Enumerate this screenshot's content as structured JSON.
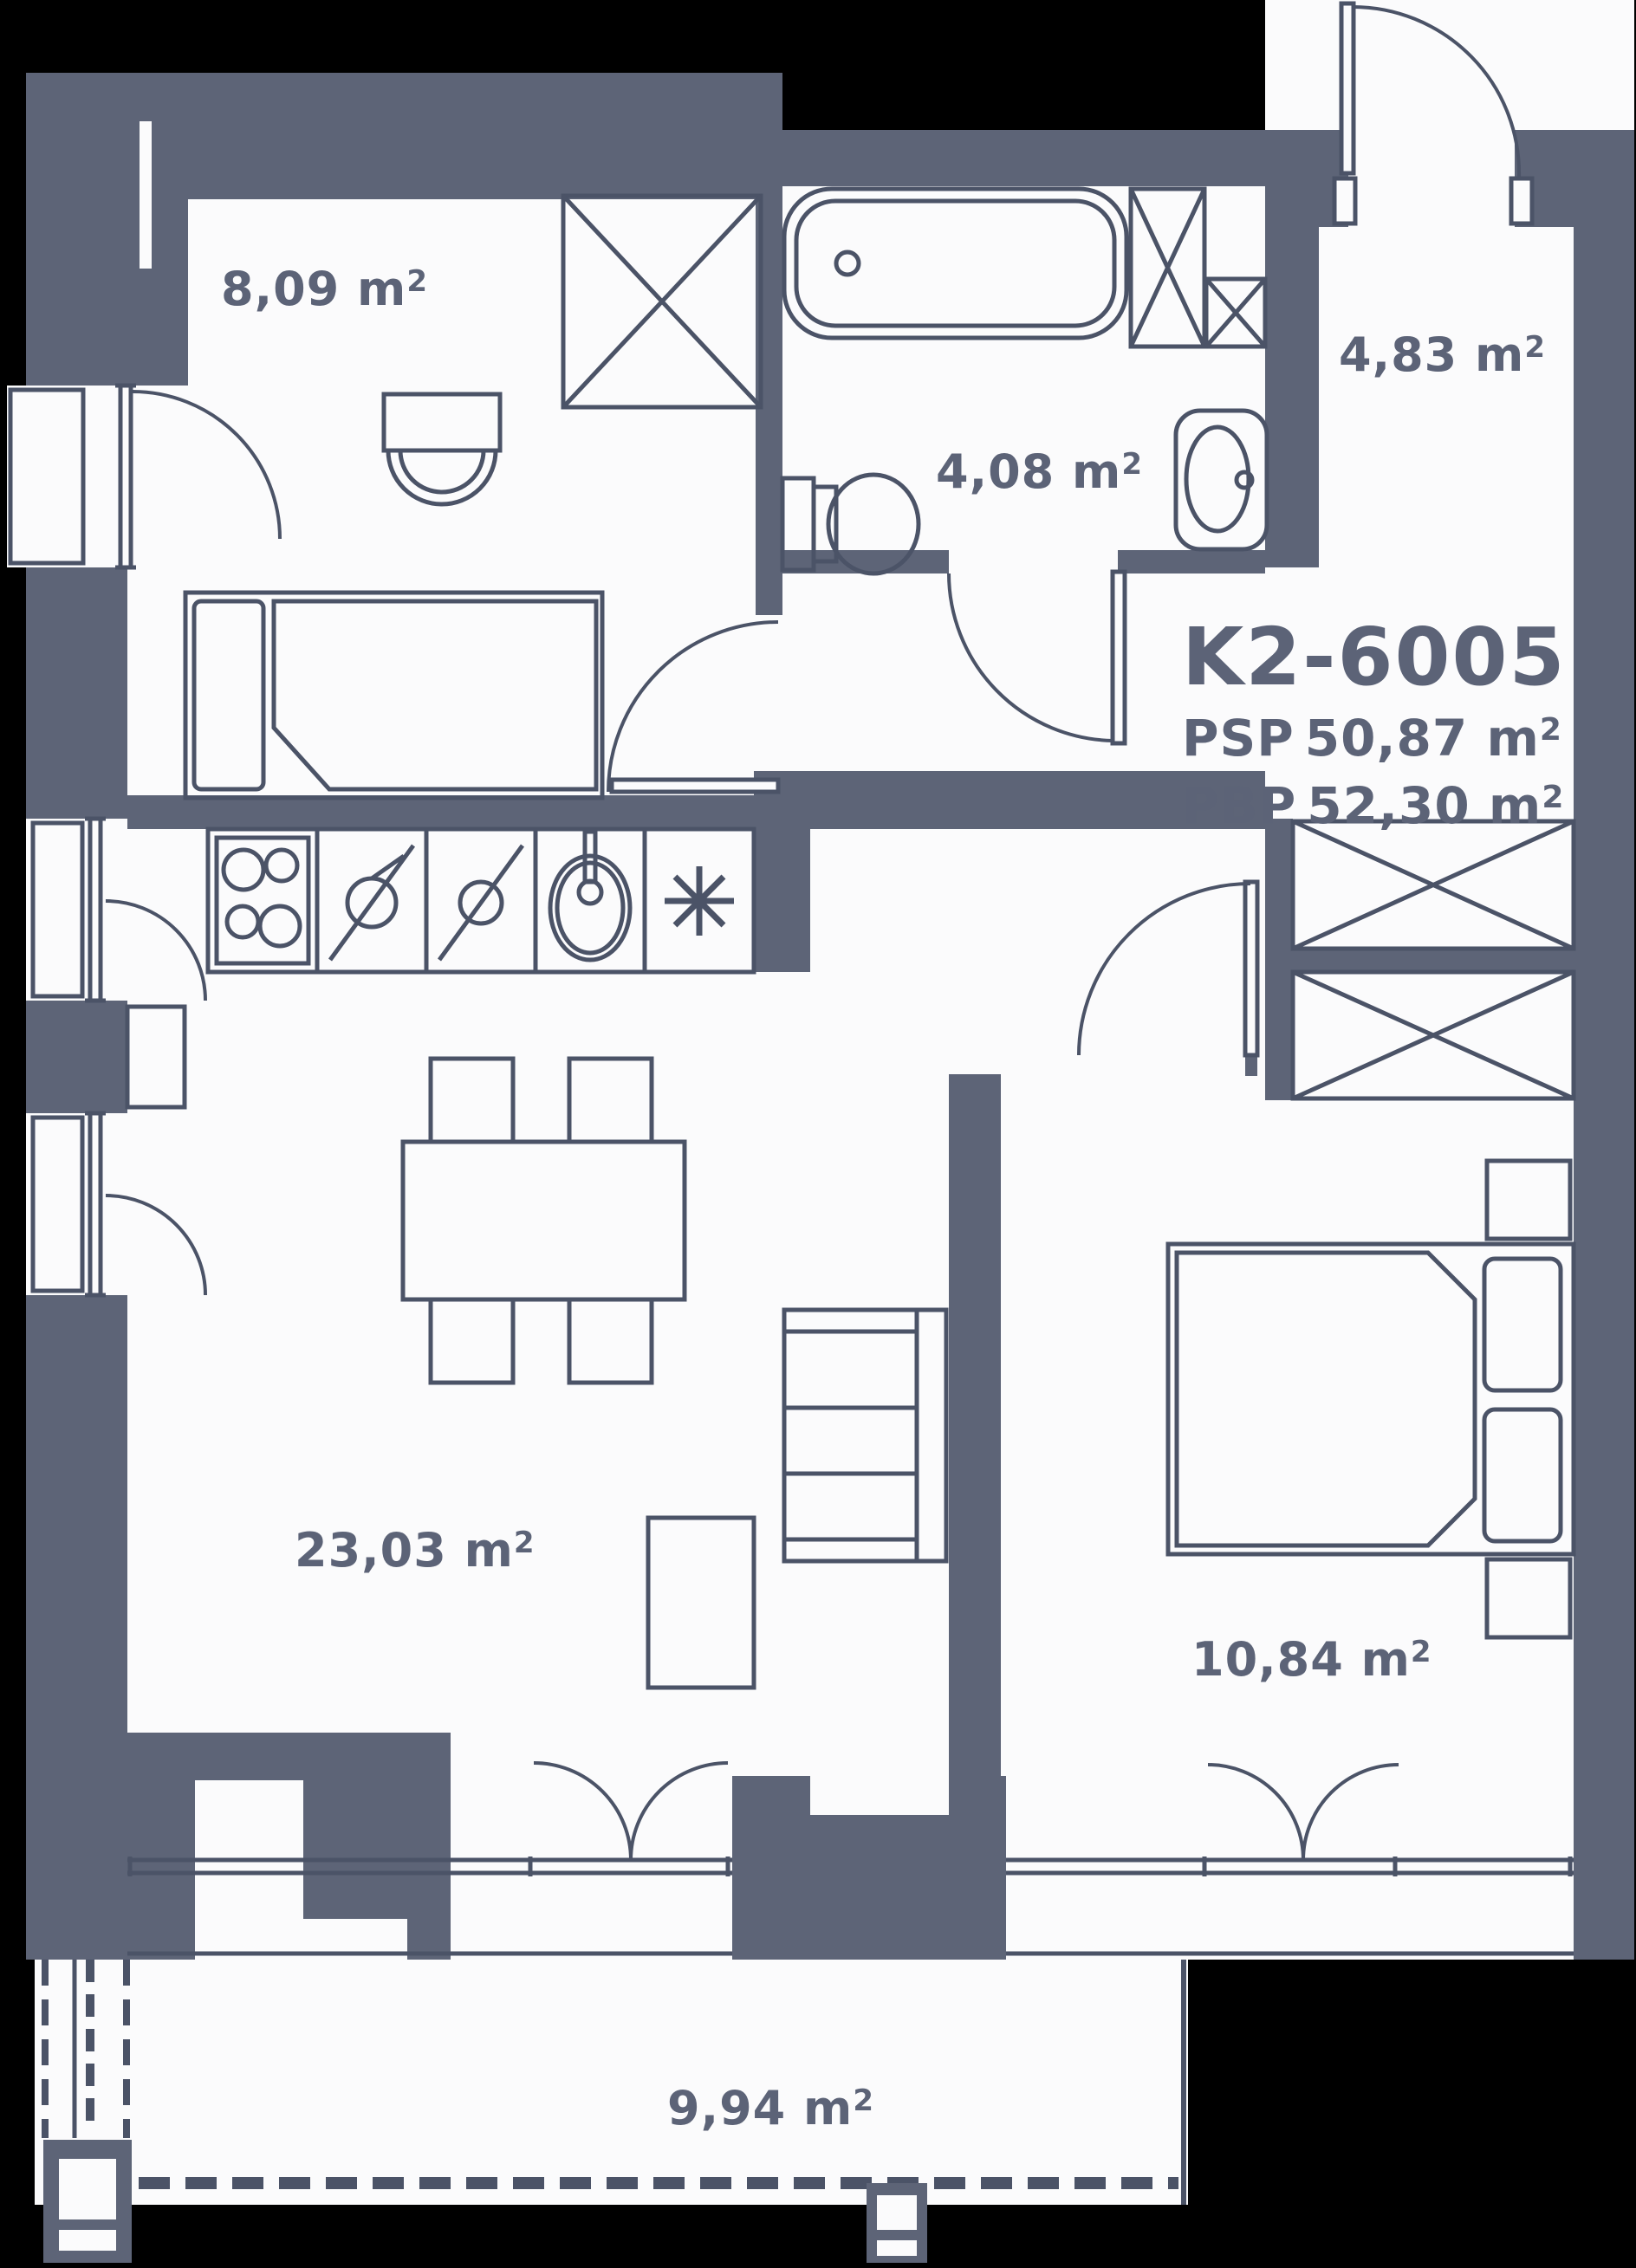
{
  "title": {
    "unit_id": "K2-6005",
    "psp_label": "PSP",
    "psp_value": "50,87",
    "pbp_label": "PBP",
    "pbp_value": "52,30"
  },
  "unit": {
    "m": " m",
    "sup": "2"
  },
  "rooms": [
    {
      "key": "small-bedroom",
      "area": "8,09"
    },
    {
      "key": "bathroom",
      "area": "4,08"
    },
    {
      "key": "entry-hall",
      "area": "4,83"
    },
    {
      "key": "living-kitchen",
      "area": "23,03"
    },
    {
      "key": "bedroom",
      "area": "10,84"
    },
    {
      "key": "balcony",
      "area": "9,94"
    }
  ],
  "colors": {
    "background": "#000000",
    "wall": "#5d6477",
    "line": "#4b5367",
    "floor": "#fbfbfc",
    "text": "#5c6377"
  },
  "icons": [
    "cooktop-icon",
    "oven-icon",
    "dishwasher-icon",
    "sink-icon",
    "fridge-asterisk-icon",
    "bathtub-icon",
    "toilet-icon",
    "washbasin-icon",
    "wardrobe-cross-icon",
    "bed-icon",
    "sofa-icon",
    "table-icon",
    "chair-icon",
    "door-swing-icon",
    "window-icon",
    "railing-icon"
  ]
}
